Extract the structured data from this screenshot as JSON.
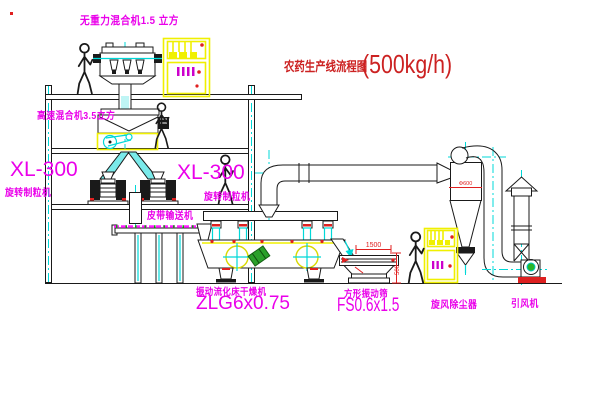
{
  "title": {
    "name": "农药生产线流程图",
    "capacity": "(500kg/h)"
  },
  "equipment_labels": {
    "gravity_mixer": "无重力混合机1.5 立方",
    "high_speed_mixer": "高速混合机3.5立方",
    "granulator_left_model": "XL-300",
    "granulator_left_name": "旋转制粒机",
    "granulator_right_model": "XL-300",
    "granulator_right_name": "旋转制粒机",
    "belt_conveyor": "皮带输送机",
    "fluid_bed_dryer_name": "振动流化床干燥机",
    "fluid_bed_dryer_model": "ZLG6x0.75",
    "vibrating_screen_name": "方形振动筛",
    "vibrating_screen_model": "FS0.6x1.5",
    "cyclone": "旋风除尘器",
    "induced_draft_fan": "引风机"
  },
  "dimensions": {
    "screen_length": "1500",
    "screen_height": "500",
    "cyclone_diameter": "Φ600"
  },
  "colors": {
    "label_magenta": "#ea00ea",
    "title_red": "#cc2222",
    "line_black": "#1a1a1a",
    "centerline_cyan": "#00d8d8",
    "equipment_yellow": "#f0f000",
    "detail_red": "#e02020",
    "detail_green": "#2aa02a"
  }
}
